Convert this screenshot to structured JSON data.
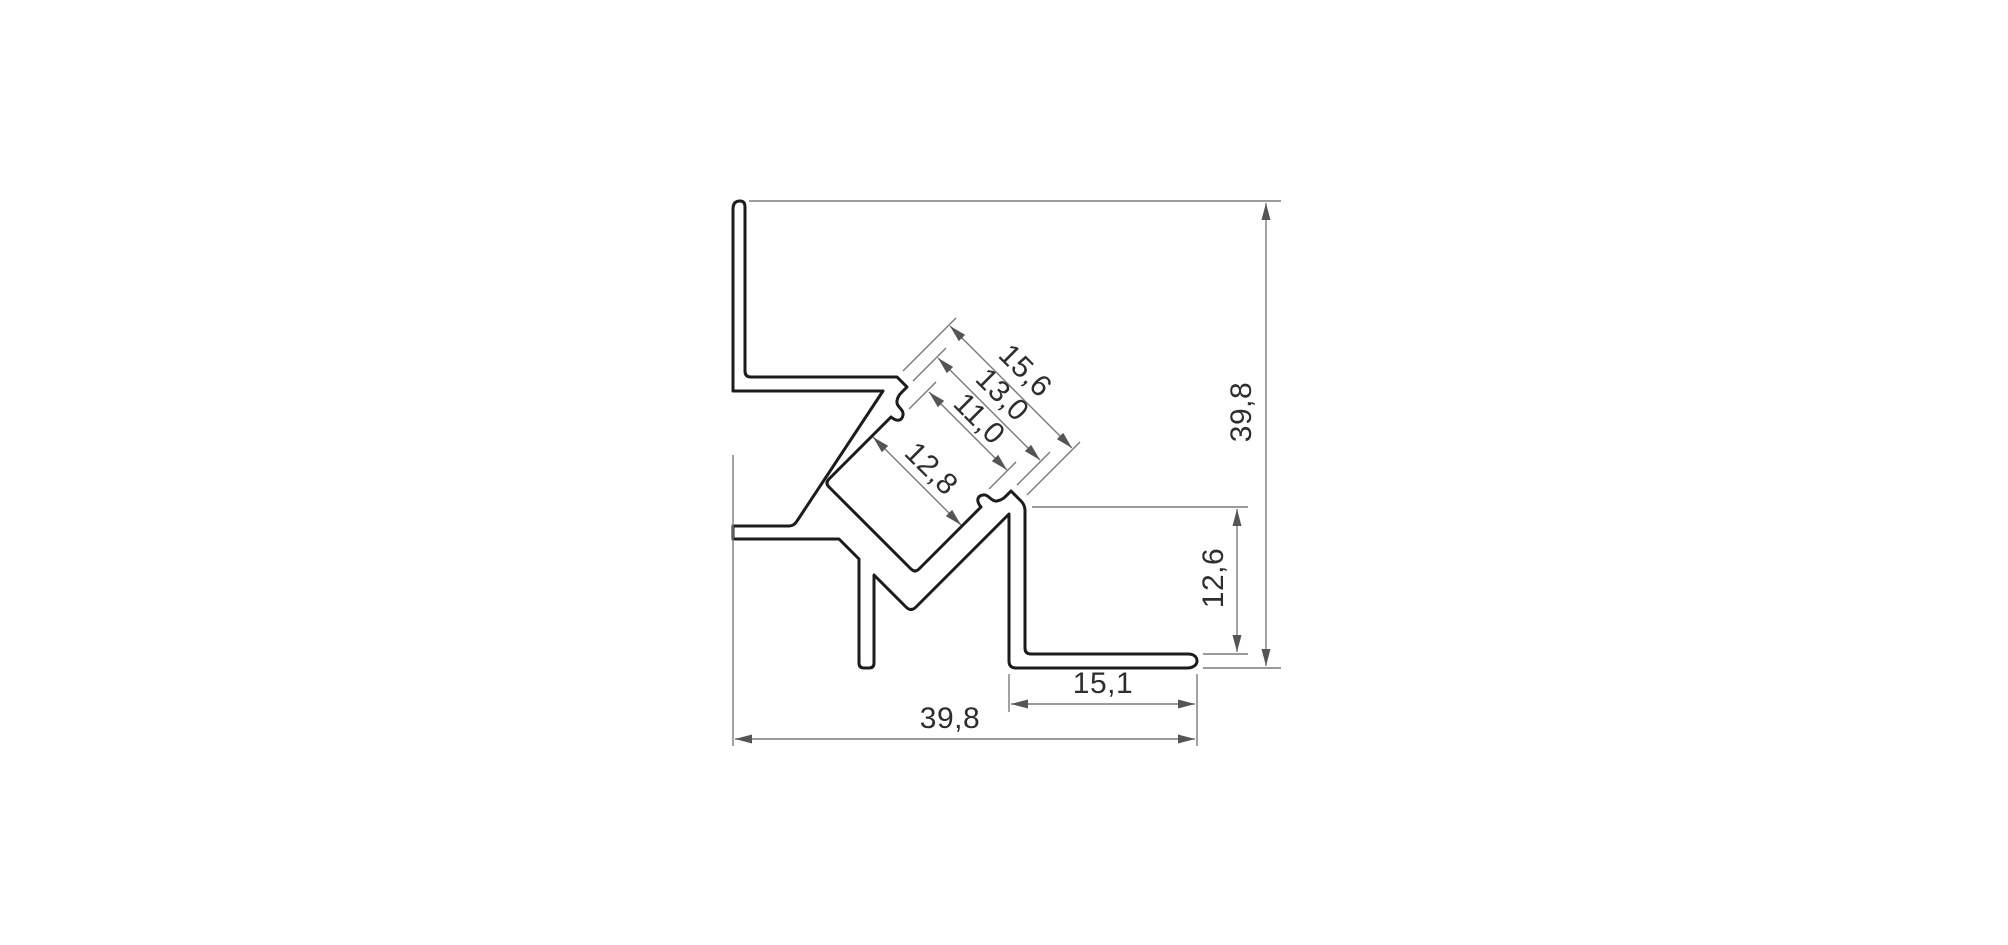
{
  "drawing": {
    "description": "Cross-section technical drawing of a 45-degree corner aluminium LED profile with dimension annotations (millimetres, comma decimal separator)",
    "units_shown": "none",
    "dimensions": {
      "overall_height": "39,8",
      "overall_width": "39,8",
      "opening_outer": "15,6",
      "opening_lip": "13,0",
      "opening_inner": "11,0",
      "channel_inner_width": "12,8",
      "right_flange_height": "12,6",
      "bottom_foot_width": "15,1"
    },
    "colors": {
      "background": "#ffffff",
      "profile_outline": "#1c1c1c",
      "profile_fill": "#ffffff",
      "dimension_lines": "#7a7a7a",
      "arrowheads": "#555555",
      "dimension_text": "#2e2e2e"
    }
  }
}
